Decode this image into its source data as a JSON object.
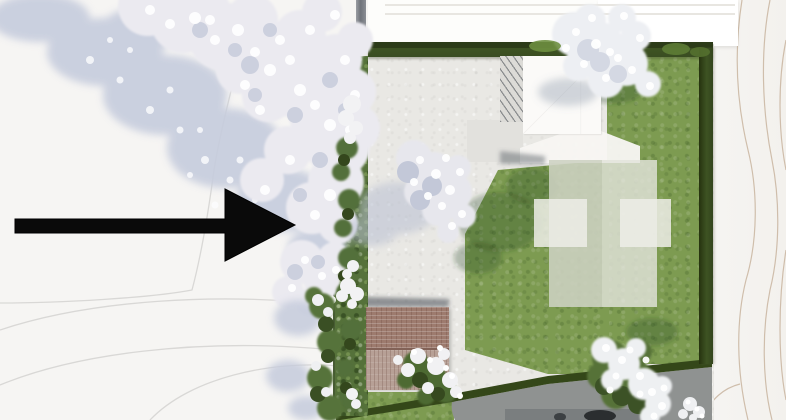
{
  "annotation_arrow": {
    "icon": "arrow-right-icon",
    "direction": "right",
    "color": "#0a0a0a"
  },
  "palette": {
    "terrain": "#f6f5f3",
    "contour_line_gray": "#d6d5d3",
    "contour_line_tan": "#c9b5a0",
    "road": "#fdfdfb",
    "sign_block": "#ffffff",
    "paving": "#e9e8e4",
    "lawn": "#7d9b51",
    "hedge": "#344719",
    "planting_bed": "#55713a",
    "house_roof": "#fbfaf8",
    "pergola": "#dcdbd7",
    "terrace": "#f7f6f2",
    "footprint_overlay": "#d4d7ca",
    "garage_roof_upper": "#9d7b6e",
    "garage_roof_lower": "#b7a096",
    "driveway": "#8f9291",
    "car": "#2b2e30",
    "tree_blossom": "#ffffff",
    "tree_canopy": "#ebeaf0",
    "tree_shadow": "#c6ccdd"
  }
}
